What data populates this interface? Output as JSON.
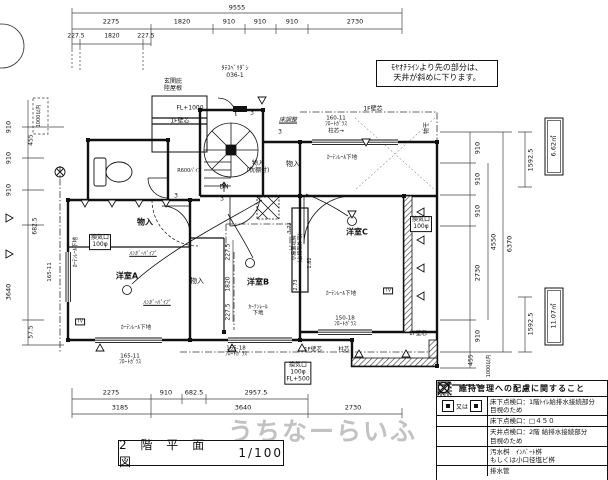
{
  "page": {
    "watermark": "うちなーらいふ"
  },
  "title_block": {
    "name": "2 階 平 面 図",
    "scale": "1/100"
  },
  "note_box": {
    "text": "ﾓﾔｵﾁﾗｲﾝより先の部分は、\n天井が斜めに下ります。"
  },
  "legend": {
    "title": "維持管理への配慮に関すること",
    "or_label": "又は",
    "rows": [
      {
        "symbol": "floor-hatch-square-pair",
        "desc": "床下点検口：1階ﾄｲﾚ給排水接続部分\n目視のため"
      },
      {
        "symbol": "x-square",
        "desc": "床下点検口：□４５０"
      },
      {
        "symbol": "hatched-x-square",
        "desc": "天井点検口：2階 給排水接続部分\n目視のため"
      },
      {
        "symbol": "circle-x",
        "desc": "汚水桝　ｲﾝﾊﾞｰﾄ桝\nもしくは小口径塩ビ桝"
      },
      {
        "symbol": "dash-dot-line",
        "desc": "排水管"
      }
    ]
  },
  "dims": {
    "top": {
      "total": "9555",
      "row2": [
        "2275",
        "1820",
        "910",
        "910",
        "910",
        "2730"
      ],
      "row3": [
        "227.5",
        "1820",
        "227.5"
      ]
    },
    "bottom": {
      "row1": [
        "2275",
        "910",
        "682.5",
        "2957.5"
      ],
      "row2": [
        "3185",
        "3640",
        "2730"
      ]
    },
    "right": {
      "chain": [
        "910",
        "910",
        "910",
        "2730",
        "910",
        "455"
      ],
      "total_inner": "4550",
      "total_outer": "6370",
      "sub": "1592.5",
      "areas": [
        "6.62㎡",
        "11.07㎡"
      ],
      "note": "1000以内"
    },
    "left": {
      "chain": [
        "910",
        "910",
        "910"
      ],
      "col2": [
        "455",
        "682.5",
        "57.5"
      ],
      "total": "3640",
      "note": "1000以内"
    },
    "inner": [
      "227.5",
      "1820",
      "227.5"
    ]
  },
  "labels": {
    "room_a": "洋室A",
    "room_b": "洋室B",
    "room_c": "洋室C",
    "storage": "物入",
    "storage_shelf": "物入\n(枕棚付)",
    "hanger_pipe": "ﾊﾝｶﾞｰﾊﾟｲﾌﾟ",
    "curtain_rail": "ｶｰﾃﾝﾚｰﾙ下地",
    "curtain_rail_2l": "ｶｰﾃﾝﾚｰﾙ\n下地",
    "vent": "換気口\n100φ",
    "vent_fl500": "換気口\n100φ\nFL+500",
    "fl1000": "FL+1000",
    "wall_core_1f": "1F壁芯",
    "post_core": "柱芯",
    "entrance_canopy": "玄関庇\n陸屋根",
    "tate_suberi": "ﾀﾃｽﾍﾞﾘﾀﾞｼ\n036-1",
    "floor_adjust": "床調整",
    "win_160_11": "160-11\nﾌﾛｰﾄｶﾞﾗｽ\n柱芯→",
    "win_165_18": "165-18\nﾌﾛｰﾄｶﾞﾗｽ",
    "win_165_11": "165-11\nﾌﾛｰﾄｶﾞﾗｽ",
    "win_165_11_v": "165-11",
    "win_150_18": "150-18\nﾌﾛｰﾄｶﾞﾗｽ",
    "dn": "DN",
    "r600": "R600ﾊﾟｲﾌﾟ",
    "step": "3",
    "tv": "TV",
    "monohoshi": "物干",
    "attic": "小屋裏収納\n(上段取外可)",
    "d273": "2.73",
    "d182": "1.82",
    "d373": "3.73"
  }
}
